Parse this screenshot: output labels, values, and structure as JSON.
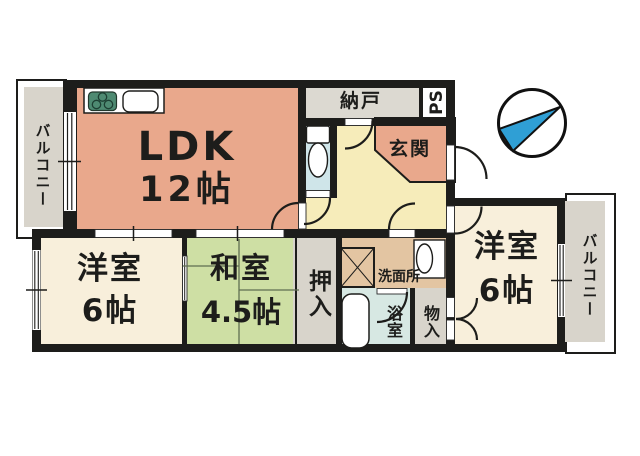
{
  "plan_type": "floor-plan",
  "rooms": {
    "ldk": {
      "label": "LDK",
      "size": "12帖"
    },
    "nando": {
      "label": "納戸"
    },
    "ps": {
      "label": "PS"
    },
    "genkan": {
      "label": "玄関"
    },
    "toilet": {
      "label": ""
    },
    "yoshitsu_left": {
      "label": "洋室",
      "size": "6帖"
    },
    "washitsu": {
      "label": "和室",
      "size": "4.5帖"
    },
    "oshiire": {
      "label": "押入"
    },
    "senmenjo": {
      "label": "洗面所"
    },
    "yokushitsu": {
      "label": "浴室"
    },
    "mononyu": {
      "label": "物入"
    },
    "yoshitsu_right": {
      "label": "洋室",
      "size": "6帖"
    },
    "balcony_left": {
      "label": "バルコニー"
    },
    "balcony_right": {
      "label": "バルコニー"
    }
  },
  "icons": {
    "compass": "north-arrow-icon",
    "kitchen_stove": "stove-burners-icon",
    "kitchen_sink": "kitchen-sink-icon",
    "toilet": "toilet-icon",
    "washing_machine": "washing-machine-icon",
    "vanity": "washbasin-icon",
    "bathtub": "bathtub-icon"
  },
  "colors": {
    "room_salmon": "#e9a88c",
    "room_cream": "#f8efdb",
    "room_green": "#cedfa4",
    "hall_yellow": "#f6ecba",
    "toilet_blue": "#cfe5e9",
    "bath_blue": "#d7e8e3",
    "service_gray": "#d8d4cb",
    "nando_gray": "#dcd9d1",
    "washroom_tan": "#e3c5a2",
    "wall": "#1d1d1b",
    "compass_blue": "#2f9fd5"
  }
}
